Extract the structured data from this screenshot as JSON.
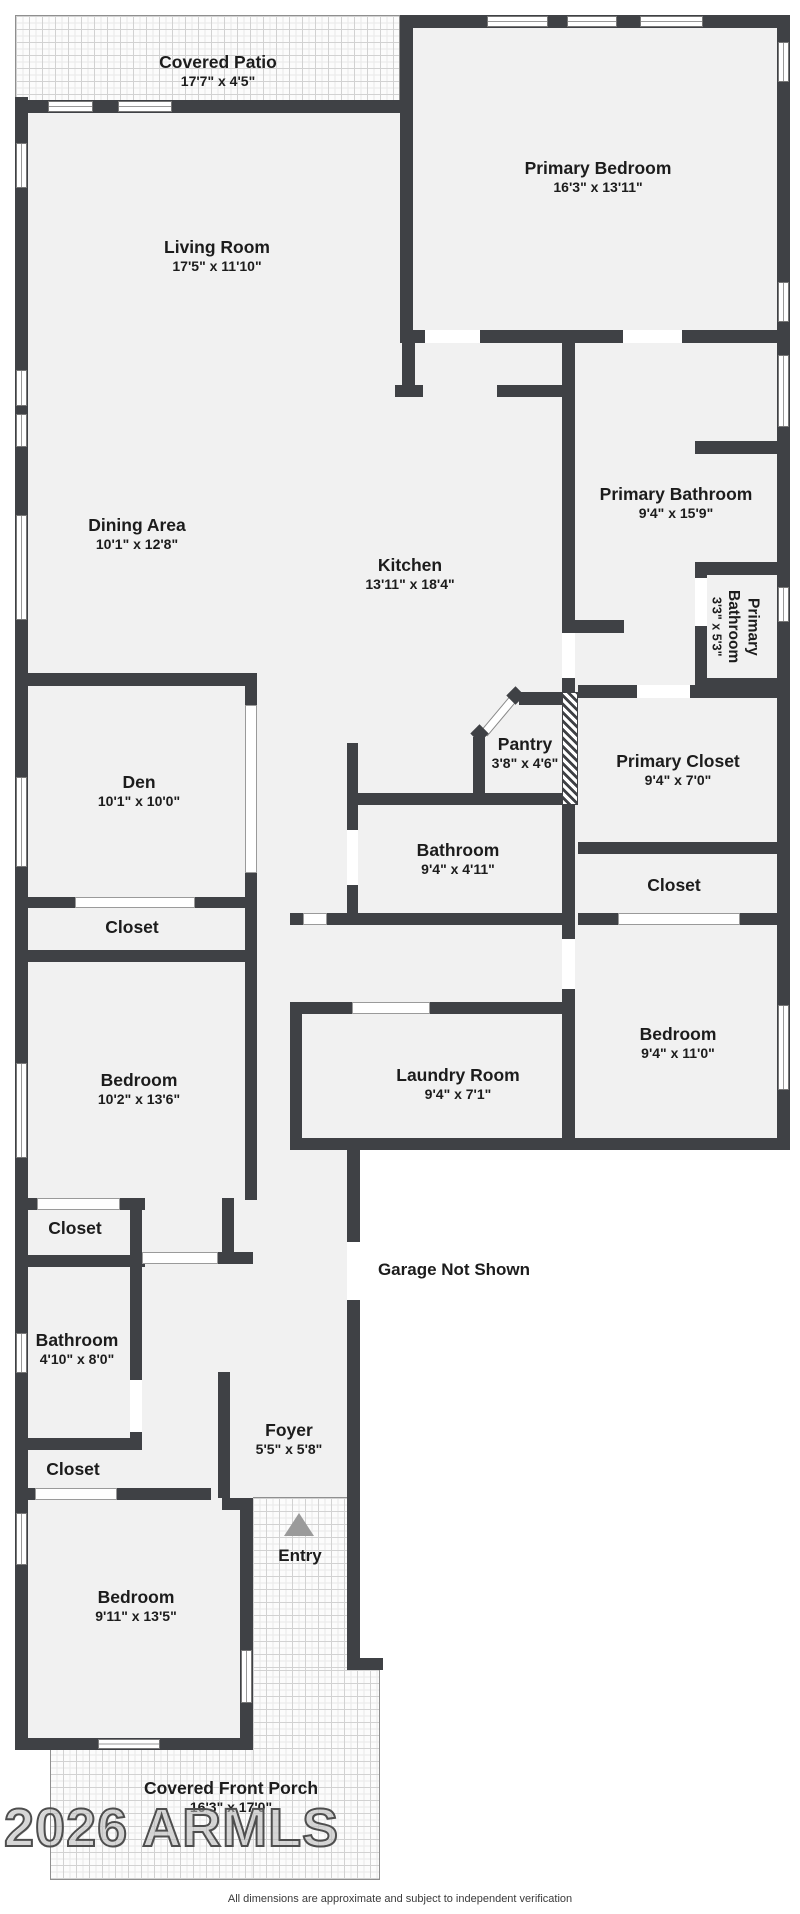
{
  "rooms": [
    {
      "name": "Covered Patio",
      "dims": "17'7\" x 4'5\""
    },
    {
      "name": "Primary Bedroom",
      "dims": "16'3\" x 13'11\""
    },
    {
      "name": "Living Room",
      "dims": "17'5\" x 11'10\""
    },
    {
      "name": "Primary Bathroom",
      "dims": "9'4\" x 15'9\""
    },
    {
      "name": "Dining Area",
      "dims": "10'1\" x 12'8\""
    },
    {
      "name": "Kitchen",
      "dims": "13'11\" x 18'4\""
    },
    {
      "name": "Primary Bathroom",
      "dims": "3'3\" x 5'3\""
    },
    {
      "name": "Den",
      "dims": "10'1\" x 10'0\""
    },
    {
      "name": "Pantry",
      "dims": "3'8\" x 4'6\""
    },
    {
      "name": "Primary Closet",
      "dims": "9'4\" x 7'0\""
    },
    {
      "name": "Bathroom",
      "dims": "9'4\" x 4'11\""
    },
    {
      "name": "Closet",
      "dims": ""
    },
    {
      "name": "Closet",
      "dims": ""
    },
    {
      "name": "Bedroom",
      "dims": "10'2\" x 13'6\""
    },
    {
      "name": "Laundry Room",
      "dims": "9'4\" x 7'1\""
    },
    {
      "name": "Bedroom",
      "dims": "9'4\" x 11'0\""
    },
    {
      "name": "Closet",
      "dims": ""
    },
    {
      "name": "Bathroom",
      "dims": "4'10\" x 8'0\""
    },
    {
      "name": "Closet",
      "dims": ""
    },
    {
      "name": "Foyer",
      "dims": "5'5\" x 5'8\""
    },
    {
      "name": "Bedroom",
      "dims": "9'11\" x 13'5\""
    },
    {
      "name": "Covered Front Porch",
      "dims": "16'3\" x 17'0\""
    }
  ],
  "annotations": {
    "garage": "Garage Not Shown",
    "entry": "Entry"
  },
  "watermark": "2026 ARMLS",
  "disclaimer": "All dimensions are approximate and subject to independent verification",
  "colors": {
    "wall": "#3f4145",
    "floor": "#f1f1f1",
    "entry_arrow": "#9a9a9a"
  }
}
